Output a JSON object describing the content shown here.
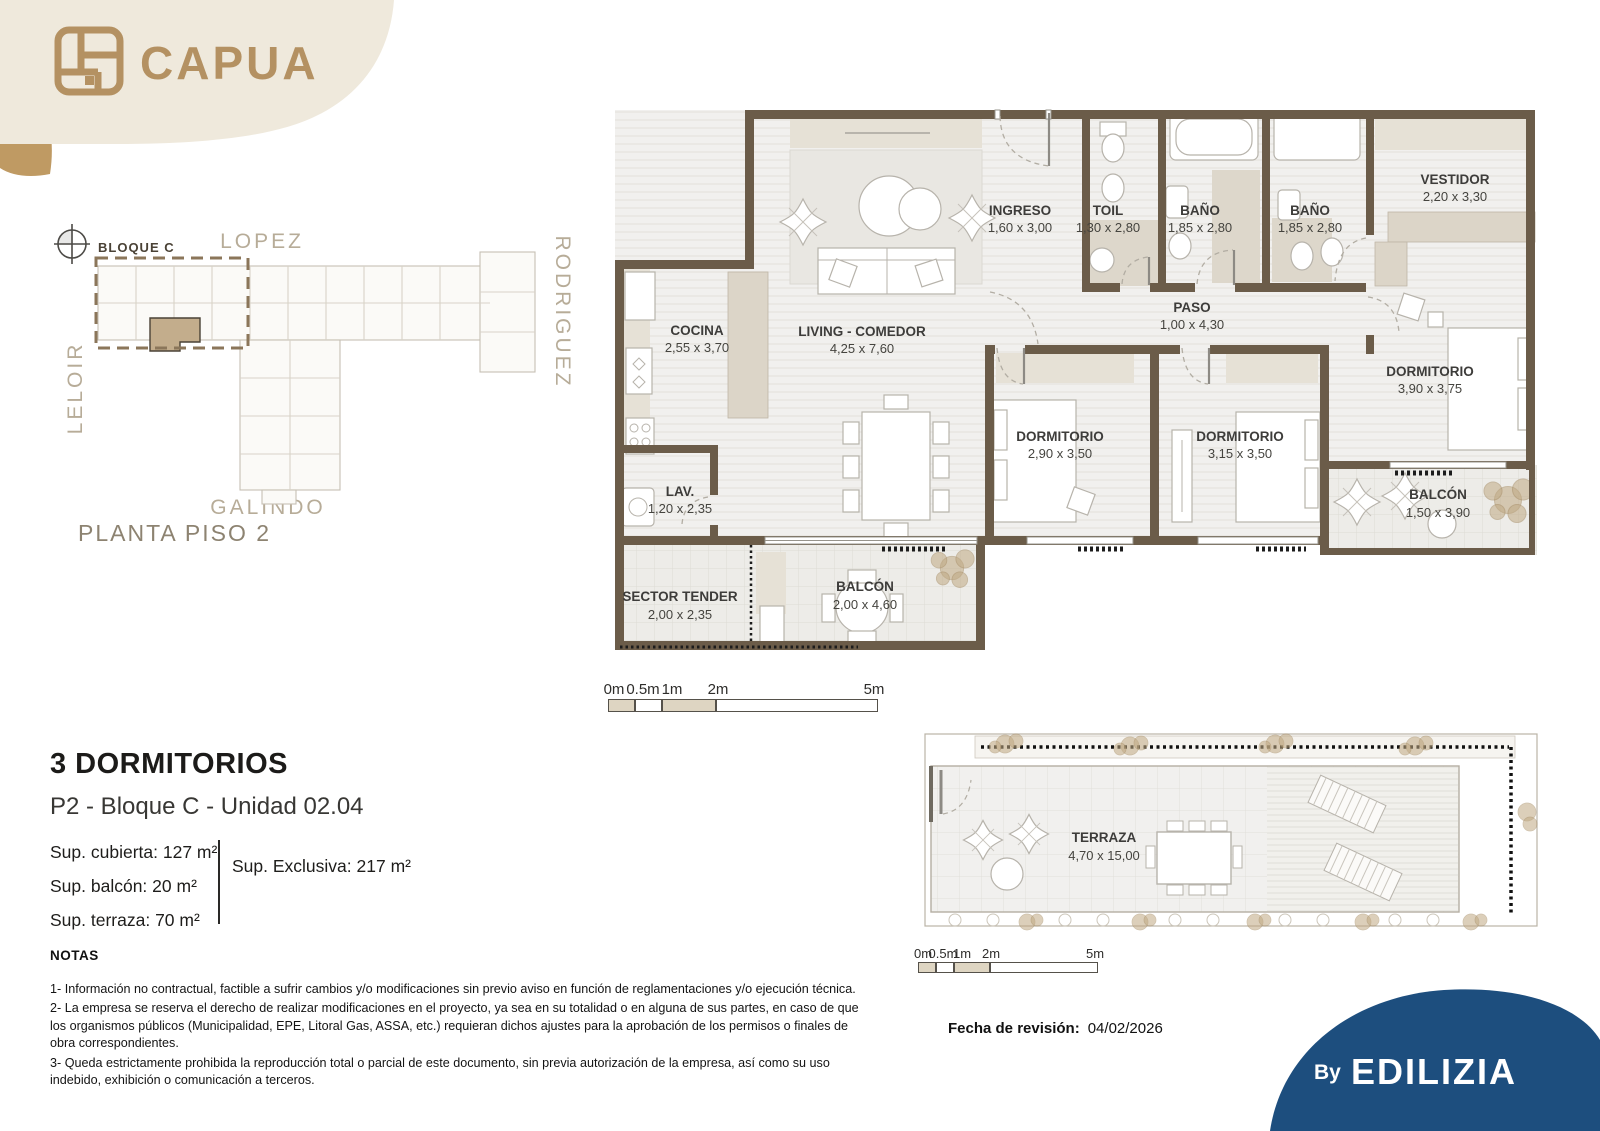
{
  "brand": {
    "name": "CAPUA"
  },
  "site_plan": {
    "block_label": "BLOQUE C",
    "streets": {
      "top": "LOPEZ",
      "left": "LELOIR",
      "right": "RODRIGUEZ",
      "bottom": "GALINDO"
    },
    "caption": "PLANTA PISO 2"
  },
  "plan": {
    "rooms": [
      {
        "name": "COCINA",
        "dims": "2,55 x 3,70"
      },
      {
        "name": "LIVING - COMEDOR",
        "dims": "4,25 x 7,60"
      },
      {
        "name": "INGRESO",
        "dims": "1,60 x 3,00"
      },
      {
        "name": "TOIL",
        "dims": "1,30 x 2,80"
      },
      {
        "name": "BAÑO",
        "dims": "1,85 x 2,80"
      },
      {
        "name": "BAÑO",
        "dims": "1,85 x 2,80"
      },
      {
        "name": "VESTIDOR",
        "dims": "2,20 x 3,30"
      },
      {
        "name": "PASO",
        "dims": "1,00 x 4,30"
      },
      {
        "name": "DORMITORIO",
        "dims": "2,90 x 3,50"
      },
      {
        "name": "DORMITORIO",
        "dims": "3,15 x 3,50"
      },
      {
        "name": "DORMITORIO",
        "dims": "3,90 x 3,75"
      },
      {
        "name": "BALCÓN",
        "dims": "1,50 x 3,90"
      },
      {
        "name": "LAV.",
        "dims": "1,20 x 2,35"
      },
      {
        "name": "SECTOR TENDER",
        "dims": "2,00 x 2,35"
      },
      {
        "name": "BALCÓN",
        "dims": "2,00 x 4,60"
      }
    ],
    "terrace": {
      "name": "TERRAZA",
      "dims": "4,70 x 15,00"
    }
  },
  "scale_bar": {
    "labels": [
      "0m",
      "0.5m",
      "1m",
      "2m",
      "5m"
    ]
  },
  "unit": {
    "type_title": "3 DORMITORIOS",
    "location": "P2 - Bloque C - Unidad 02.04",
    "areas": [
      {
        "label": "Sup. cubierta:",
        "value": "127 m²"
      },
      {
        "label": "Sup. balcón:",
        "value": "20 m²"
      },
      {
        "label": "Sup. terraza:",
        "value": "70 m²"
      }
    ],
    "exclusive": {
      "label": "Sup. Exclusiva:",
      "value": "217 m²"
    }
  },
  "notes": {
    "heading": "NOTAS",
    "items": [
      "1- Información no contractual, factible a sufrir cambios y/o modificaciones sin previo aviso en función de reglamentaciones y/o ejecución técnica.",
      "2- La empresa se reserva el derecho de realizar modificaciones en el proyecto, ya sea en su totalidad o en alguna de sus partes, en caso de que los organismos públicos (Municipalidad, EPE, Litoral Gas, ASSA, etc.) requieran dichos ajustes para la aprobación de los permisos o finales de obra correspondientes.",
      "3- Queda estrictamente prohibida la reproducción total o parcial de este documento, sin previa autorización de la empresa, así como su uso indebido, exhibición o comunicación a terceros."
    ]
  },
  "revision": {
    "label": "Fecha de revisión:",
    "value": "04/02/2026"
  },
  "footer": {
    "by": "By",
    "brand": "EDILIZIA"
  },
  "colors": {
    "accent_gold": "#b49162",
    "cream": "#efe9dc",
    "wall_brown": "#6b5c49",
    "navy": "#1d4e7e"
  }
}
